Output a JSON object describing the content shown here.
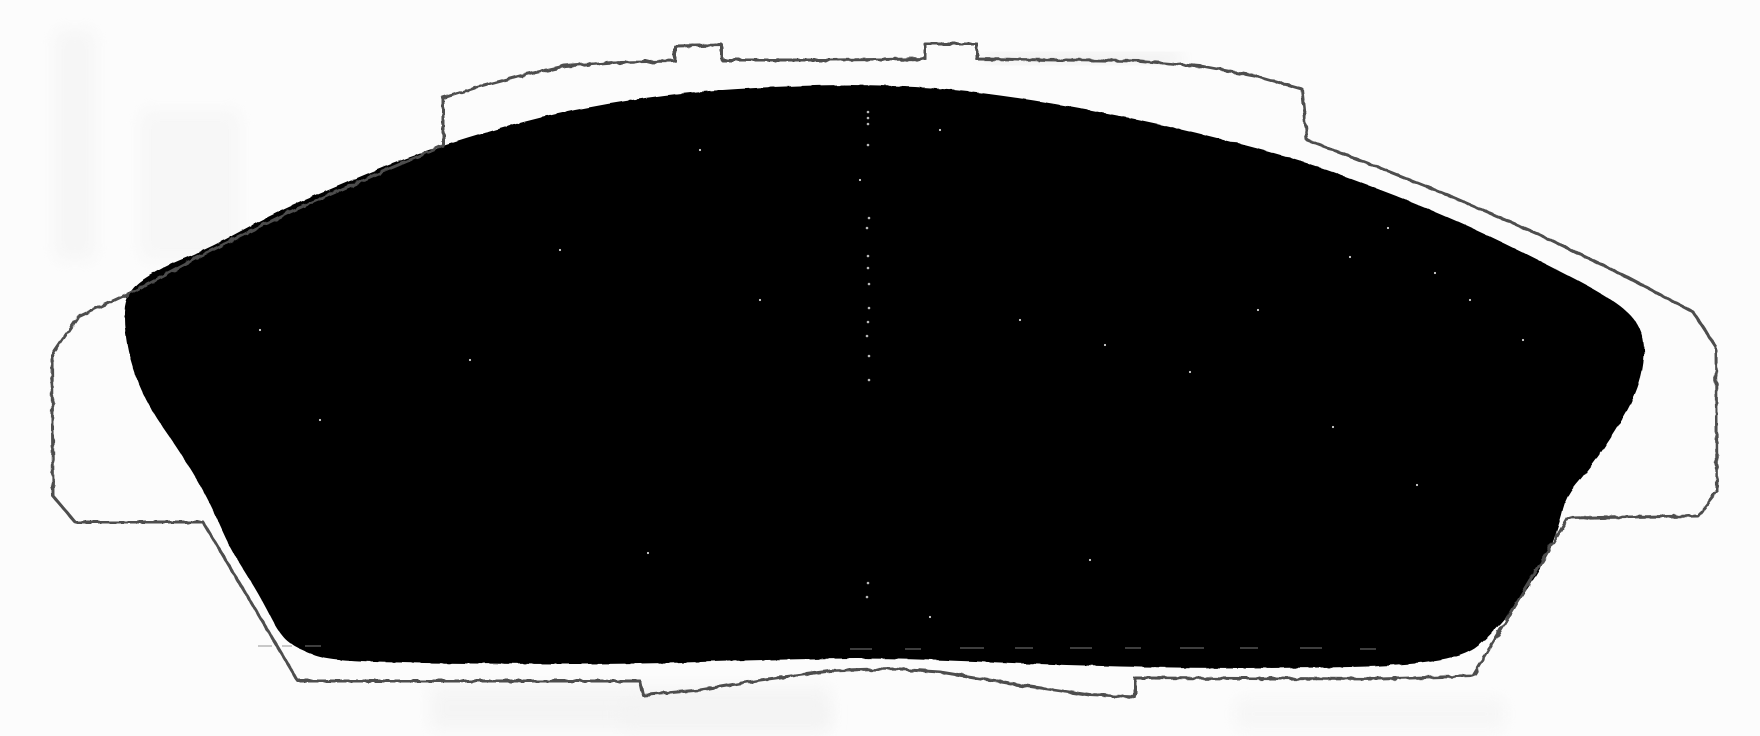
{
  "meta": {
    "description": "Scanned black-and-white line-art drawing of a disc brake pad; backing plate shown as a thin fuzzy outline, friction material as a solid black arched trapezoid",
    "canvas_width": 1760,
    "canvas_height": 736
  },
  "colors": {
    "background": "#fcfcfc",
    "plate_outline": "#4d4d4d",
    "friction_fill": "#060606",
    "speckle": "#f6f6f6",
    "scuff": "#8a8a8a"
  },
  "shapes": {
    "backing_plate": {
      "stroke_width": 3,
      "points": [
        [
          78,
          317
        ],
        [
          130,
          293
        ],
        [
          200,
          256
        ],
        [
          290,
          212
        ],
        [
          370,
          177
        ],
        [
          443,
          146
        ],
        [
          443,
          98
        ],
        [
          475,
          88
        ],
        [
          520,
          76
        ],
        [
          565,
          66
        ],
        [
          620,
          62
        ],
        [
          675,
          61
        ],
        [
          675,
          46
        ],
        [
          722,
          45
        ],
        [
          722,
          60
        ],
        [
          830,
          60
        ],
        [
          925,
          59
        ],
        [
          925,
          44
        ],
        [
          977,
          44
        ],
        [
          977,
          59
        ],
        [
          1060,
          60
        ],
        [
          1140,
          61
        ],
        [
          1200,
          66
        ],
        [
          1260,
          77
        ],
        [
          1302,
          89
        ],
        [
          1307,
          140
        ],
        [
          1370,
          164
        ],
        [
          1450,
          196
        ],
        [
          1540,
          235
        ],
        [
          1625,
          276
        ],
        [
          1693,
          312
        ],
        [
          1716,
          347
        ],
        [
          1717,
          492
        ],
        [
          1698,
          516
        ],
        [
          1568,
          518
        ],
        [
          1473,
          676
        ],
        [
          1380,
          679
        ],
        [
          1135,
          678
        ],
        [
          1135,
          697
        ],
        [
          1090,
          695
        ],
        [
          1020,
          685
        ],
        [
          940,
          672
        ],
        [
          893,
          669
        ],
        [
          830,
          671
        ],
        [
          760,
          680
        ],
        [
          700,
          690
        ],
        [
          643,
          695
        ],
        [
          640,
          681
        ],
        [
          520,
          681
        ],
        [
          298,
          681
        ],
        [
          203,
          522
        ],
        [
          75,
          522
        ],
        [
          53,
          496
        ],
        [
          52,
          355
        ]
      ]
    },
    "friction_pad": {
      "points": [
        [
          125,
          292
        ],
        [
          160,
          268
        ],
        [
          210,
          248
        ],
        [
          270,
          215
        ],
        [
          333,
          188
        ],
        [
          400,
          160
        ],
        [
          467,
          138
        ],
        [
          540,
          117
        ],
        [
          610,
          103
        ],
        [
          680,
          93
        ],
        [
          750,
          88
        ],
        [
          820,
          85
        ],
        [
          880,
          85
        ],
        [
          950,
          89
        ],
        [
          1020,
          98
        ],
        [
          1090,
          110
        ],
        [
          1160,
          124
        ],
        [
          1230,
          141
        ],
        [
          1300,
          160
        ],
        [
          1365,
          184
        ],
        [
          1425,
          207
        ],
        [
          1490,
          236
        ],
        [
          1550,
          266
        ],
        [
          1600,
          292
        ],
        [
          1633,
          315
        ],
        [
          1645,
          340
        ],
        [
          1643,
          372
        ],
        [
          1632,
          403
        ],
        [
          1610,
          440
        ],
        [
          1586,
          473
        ],
        [
          1566,
          496
        ],
        [
          1560,
          522
        ],
        [
          1548,
          556
        ],
        [
          1522,
          598
        ],
        [
          1492,
          634
        ],
        [
          1465,
          657
        ],
        [
          1400,
          666
        ],
        [
          1300,
          668
        ],
        [
          1180,
          668
        ],
        [
          1060,
          665
        ],
        [
          940,
          660
        ],
        [
          860,
          658
        ],
        [
          760,
          660
        ],
        [
          640,
          664
        ],
        [
          520,
          664
        ],
        [
          420,
          663
        ],
        [
          330,
          661
        ],
        [
          300,
          650
        ],
        [
          281,
          637
        ],
        [
          262,
          600
        ],
        [
          247,
          575
        ],
        [
          230,
          548
        ],
        [
          214,
          512
        ],
        [
          198,
          481
        ],
        [
          176,
          446
        ],
        [
          150,
          409
        ],
        [
          133,
          371
        ],
        [
          124,
          331
        ]
      ]
    },
    "center_seam": {
      "x": 868,
      "dot_ys": [
        112,
        118,
        124,
        145,
        218,
        228,
        256,
        268,
        284,
        308,
        322,
        336,
        356,
        380,
        583,
        597
      ]
    },
    "speckles": [
      [
        260,
        330
      ],
      [
        320,
        420
      ],
      [
        470,
        360
      ],
      [
        560,
        250
      ],
      [
        648,
        553
      ],
      [
        700,
        150
      ],
      [
        760,
        300
      ],
      [
        860,
        180
      ],
      [
        930,
        617
      ],
      [
        940,
        130
      ],
      [
        1020,
        320
      ],
      [
        1090,
        560
      ],
      [
        1105,
        345
      ],
      [
        1190,
        372
      ],
      [
        1258,
        310
      ],
      [
        1333,
        427
      ],
      [
        1350,
        257
      ],
      [
        1388,
        228
      ],
      [
        1417,
        485
      ],
      [
        1435,
        273
      ],
      [
        1470,
        300
      ],
      [
        1523,
        340
      ]
    ],
    "scuff_marks": {
      "height": 2,
      "items": [
        [
          258,
          645,
          14
        ],
        [
          282,
          645,
          10
        ],
        [
          305,
          645,
          16
        ],
        [
          850,
          648,
          22
        ],
        [
          905,
          648,
          16
        ],
        [
          960,
          647,
          24
        ],
        [
          1015,
          647,
          18
        ],
        [
          1070,
          647,
          22
        ],
        [
          1125,
          647,
          16
        ],
        [
          1180,
          647,
          24
        ],
        [
          1240,
          647,
          18
        ],
        [
          1300,
          647,
          22
        ],
        [
          1360,
          648,
          16
        ]
      ]
    },
    "shade_patches": [
      [
        55,
        30,
        40,
        230,
        "#f1f1f1",
        0.55
      ],
      [
        140,
        110,
        100,
        150,
        "#f3f3f3",
        0.55
      ],
      [
        430,
        686,
        400,
        44,
        "#f2f2f2",
        0.7
      ],
      [
        620,
        700,
        210,
        30,
        "#f3f3f3",
        0.6
      ],
      [
        1235,
        698,
        270,
        32,
        "#f5f5f5",
        0.8
      ],
      [
        985,
        55,
        195,
        7,
        "#9a9a9a",
        0.22
      ]
    ]
  }
}
